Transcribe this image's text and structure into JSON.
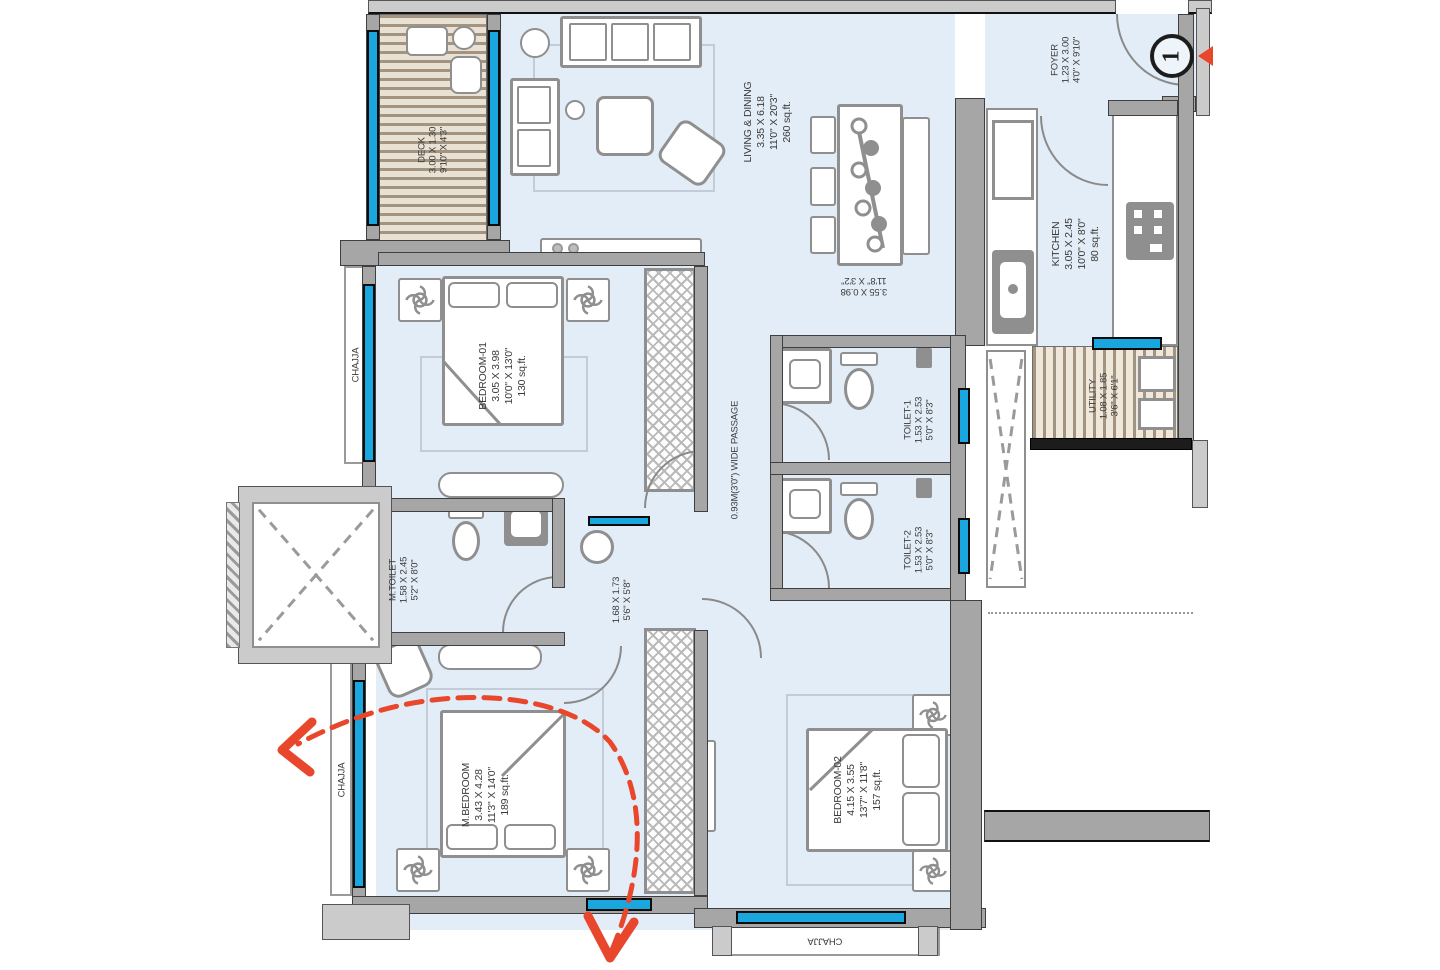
{
  "labels": {
    "chajja": "CHAJJA",
    "passage": "0.93M(3'0\") WIDE PASSAGE",
    "entry_number": "1"
  },
  "rooms": {
    "deck": {
      "name": "DECK",
      "dims_m": "3.00 X 1.30",
      "dims_ft": "9'10\" X 4'3\""
    },
    "living_dining": {
      "name": "LIVING & DINING",
      "dims_m": "3.35 X 6.18",
      "dims_ft": "11'0\" X 20'3\"",
      "area": "260 sq.ft."
    },
    "dining_area": {
      "dims_m": "3.55 X 0.98",
      "dims_ft": "11'8\" X 3'2\""
    },
    "foyer": {
      "name": "FOYER",
      "dims_m": "1.23 X 3.00",
      "dims_ft": "4'0\" X 9'10\""
    },
    "kitchen": {
      "name": "KITCHEN",
      "dims_m": "3.05 X 2.45",
      "dims_ft": "10'0\" X 8'0\"",
      "area": "80 sq.ft."
    },
    "utility": {
      "name": "UTILITY",
      "dims_m": "1.08 X 1.85",
      "dims_ft": "3'6\" X 6'1\""
    },
    "bedroom_01": {
      "name": "BEDROOM-01",
      "dims_m": "3.05 X 3.98",
      "dims_ft": "10'0\" X 13'0\"",
      "area": "130 sq.ft."
    },
    "toilet_1": {
      "name": "TOILET-1",
      "dims_m": "1.53 X 2.53",
      "dims_ft": "5'0\" X 8'3\""
    },
    "toilet_2": {
      "name": "TOILET-2",
      "dims_m": "1.53 X 2.53",
      "dims_ft": "5'0\" X 8'3\""
    },
    "m_toilet": {
      "name": "M.TOILET",
      "dims_m": "1.58 X 2.45",
      "dims_ft": "5'2\" X 8'0\""
    },
    "passage_lobby": {
      "dims_m": "1.68 X 1.73",
      "dims_ft": "5'6\" X 5'8\""
    },
    "m_bedroom": {
      "name": "M.BEDROOM",
      "dims_m": "3.43 X 4.28",
      "dims_ft": "11'3\" X 14'0\"",
      "area": "189 sq.ft."
    },
    "bedroom_02": {
      "name": "BEDROOM-02",
      "dims_m": "4.15 X 3.55",
      "dims_ft": "13'7\" X 11'8\"",
      "area": "157 sq.ft."
    }
  },
  "colors": {
    "floor": "#e3edf7",
    "wall": "#a6a6a6",
    "window": "#1aa7e0",
    "accent_red": "#e8472b",
    "hatch": "#a39482"
  }
}
